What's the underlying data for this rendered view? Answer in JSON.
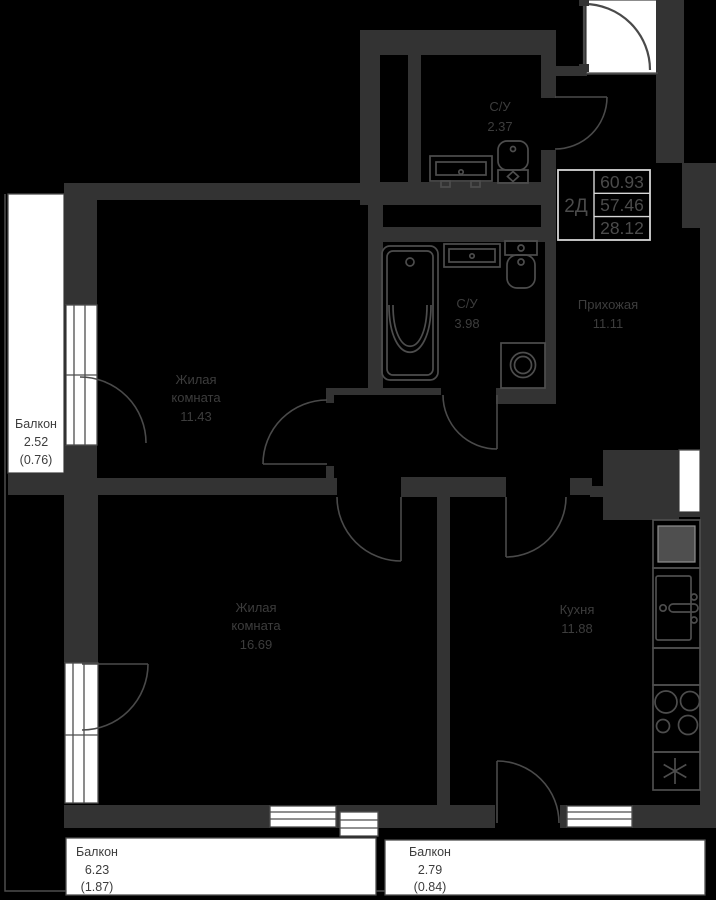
{
  "info_box": {
    "type": "2Д",
    "areas": [
      "60.93",
      "57.46",
      "28.12"
    ]
  },
  "rooms": {
    "su_top": {
      "name": "С/У",
      "area": "2.37"
    },
    "su_main": {
      "name": "С/У",
      "area": "3.98"
    },
    "hallway": {
      "name": "Прихожая",
      "area": "11.11"
    },
    "living1": {
      "name_l1": "Жилая",
      "name_l2": "комната",
      "area": "11.43"
    },
    "living2": {
      "name_l1": "Жилая",
      "name_l2": "комната",
      "area": "16.69"
    },
    "kitchen": {
      "name": "Кухня",
      "area": "11.88"
    }
  },
  "balconies": {
    "left": {
      "name": "Балкон",
      "area": "2.52",
      "coef": "(0.76)"
    },
    "bottom_left": {
      "name": "Балкон",
      "area": "6.23",
      "coef": "(1.87)"
    },
    "bottom_right": {
      "name": "Балкон",
      "area": "2.79",
      "coef": "(0.84)"
    }
  },
  "fixtures": [
    "bathtub",
    "sink",
    "toilet",
    "washing-machine",
    "refrigerator",
    "kitchen-sink",
    "stove-burners",
    "snowflake"
  ],
  "colors": {
    "background": "#000000",
    "wall": "#333333",
    "line": "#4d4d4d",
    "door": "#4a4a4a",
    "text": "#3d3d3d",
    "white": "#ffffff",
    "info_border": "#d6d6d6",
    "info_text": "#4b4b4b"
  }
}
